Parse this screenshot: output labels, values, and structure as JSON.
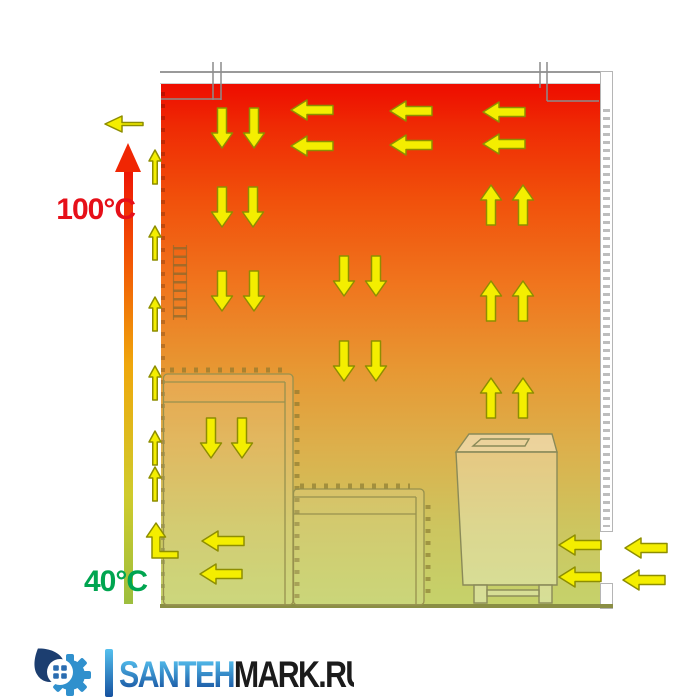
{
  "scene": {
    "temperature_scale": {
      "max_label": "100°C",
      "min_label": "40°C",
      "max_color": "#e61019",
      "min_color": "#00a550",
      "bar_gradient": [
        "#9dbe3e",
        "#cfcb2c",
        "#efa70c",
        "#f25304",
        "#ee1505"
      ],
      "bar_positions": [
        0,
        25,
        55,
        80,
        100
      ]
    },
    "room_gradient": {
      "stops": [
        "#ee0c00",
        "#ef2a04",
        "#f1500b",
        "#f0741d",
        "#e79833",
        "#dcb04c",
        "#cdc55f",
        "#c5d26b"
      ],
      "positions": [
        0,
        8,
        22,
        38,
        55,
        70,
        85,
        100
      ]
    },
    "colors": {
      "arrow_fill": "#f4ee00",
      "arrow_stroke": "#8e8e00",
      "structure_outline": "#97914e",
      "wall_border": "#a6a6a6",
      "floor": "#8a8e44",
      "duct_line": "#8c8c8c"
    },
    "airflow": {
      "big_arrows": [
        {
          "d": "down",
          "x": 222,
          "y": 128
        },
        {
          "d": "down",
          "x": 254,
          "y": 128
        },
        {
          "d": "down",
          "x": 222,
          "y": 207
        },
        {
          "d": "down",
          "x": 253,
          "y": 207
        },
        {
          "d": "down",
          "x": 222,
          "y": 291
        },
        {
          "d": "down",
          "x": 254,
          "y": 291
        },
        {
          "d": "down",
          "x": 211,
          "y": 438
        },
        {
          "d": "down",
          "x": 242,
          "y": 438
        },
        {
          "d": "down",
          "x": 344,
          "y": 276
        },
        {
          "d": "down",
          "x": 376,
          "y": 276
        },
        {
          "d": "down",
          "x": 344,
          "y": 361
        },
        {
          "d": "down",
          "x": 376,
          "y": 361
        },
        {
          "d": "up",
          "x": 491,
          "y": 205
        },
        {
          "d": "up",
          "x": 523,
          "y": 205
        },
        {
          "d": "up",
          "x": 491,
          "y": 301
        },
        {
          "d": "up",
          "x": 523,
          "y": 301
        },
        {
          "d": "up",
          "x": 491,
          "y": 398
        },
        {
          "d": "up",
          "x": 523,
          "y": 398
        },
        {
          "d": "left",
          "x": 312,
          "y": 110
        },
        {
          "d": "left",
          "x": 312,
          "y": 146
        },
        {
          "d": "left",
          "x": 411,
          "y": 111
        },
        {
          "d": "left",
          "x": 411,
          "y": 145
        },
        {
          "d": "left",
          "x": 504,
          "y": 112
        },
        {
          "d": "left",
          "x": 504,
          "y": 144
        },
        {
          "d": "left",
          "x": 223,
          "y": 541
        },
        {
          "d": "left",
          "x": 221,
          "y": 574
        },
        {
          "d": "left",
          "x": 580,
          "y": 545
        },
        {
          "d": "left",
          "x": 580,
          "y": 577
        },
        {
          "d": "left",
          "x": 646,
          "y": 548
        },
        {
          "d": "left",
          "x": 644,
          "y": 580
        }
      ],
      "wall_arrows_x": 155,
      "wall_arrows_y": [
        167,
        243,
        314,
        383,
        448,
        484
      ],
      "exit_arrow": {
        "x": 124,
        "y": 124
      },
      "bent_arrow": {
        "x": 156,
        "y": 540
      }
    }
  },
  "logo": {
    "brand_primary": "SANTEH",
    "brand_secondary": "MARK.RU",
    "primary_top": "#55c0ee",
    "primary_bottom": "#16519f",
    "secondary_color": "#1b1b1b",
    "icon_name": "gear-drop-window-icon"
  }
}
